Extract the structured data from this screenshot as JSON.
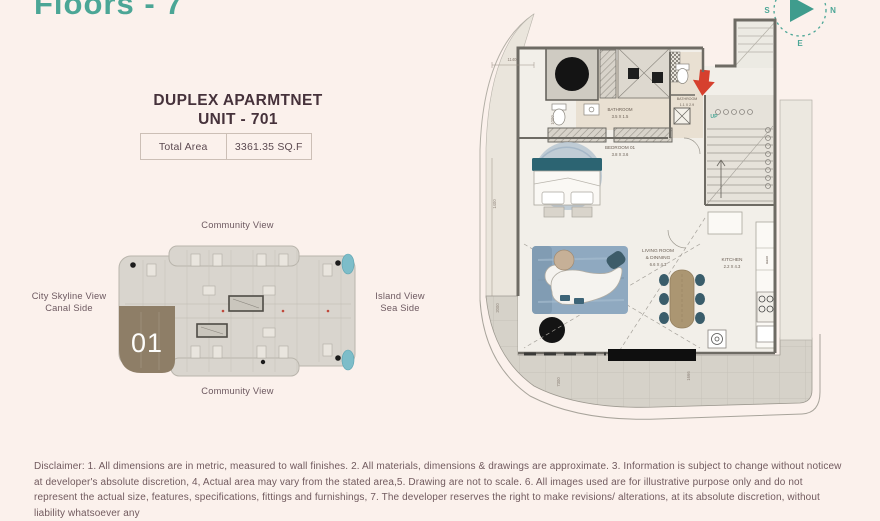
{
  "header": {
    "title": "Floors - 7",
    "compass": {
      "n": "N",
      "e": "E",
      "s": "S",
      "w": "W"
    }
  },
  "unit_info": {
    "heading_line1": "DUPLEX APARMTNET",
    "heading_line2": "UNIT - 701",
    "total_area_label": "Total Area",
    "total_area_value": "3361.35 SQ.F"
  },
  "key_plan": {
    "unit_number": "01",
    "view_top": "Community View",
    "view_bottom": "Community View",
    "view_left_line1": "City Skyline View",
    "view_left_line2": "Canal Side",
    "view_right_line1": "Island View",
    "view_right_line2": "Sea Side"
  },
  "floor_plan": {
    "bathroom1_name": "BATHROOM",
    "bathroom1_dims": "3.5 X 1.5",
    "bathroom2_name": "BATHROOM",
    "bathroom2_dims": "1.1 X 2.9",
    "bedroom_name": "BEDROOM 01",
    "bedroom_dims": "3.8 X 3.6",
    "living_name_line1": "LIVING ROOM",
    "living_name_line2": "& DINNING",
    "living_dims": "6.6 X 4.3",
    "kitchen_name": "KITCHEN",
    "kitchen_dims": "2.2 X 4.3",
    "oven_label": "oven",
    "up_label": "UP",
    "dim_top": "1140",
    "dim_vanity": "1000",
    "dim_left_mid": "1400",
    "dim_left_low": "2000",
    "dim_terrace": "7300",
    "dim_terrace_right": "1666"
  },
  "colors": {
    "accent_teal": "#4ba696",
    "heading_text": "#46323b",
    "label_text": "#6d5960",
    "unit_fill": "#8e7e67",
    "entry_arrow": "#d6402e",
    "wall": "#6e6b64",
    "rug": "#8fa9c0",
    "bed_headboard": "#2c6472",
    "pool": "#7dbdc9"
  },
  "disclaimer": "Disclaimer: 1. All dimensions are in metric, measured to wall finishes. 2. All materials, dimensions & drawings are approximate. 3. Information is subject to change without noticew at developer's absolute discretion, 4, Actual area may vary from the stated area,5. Drawing are not to scale. 6. All images used are for illustrative purpose only and do not represent the actual size, features, specifications, fittings and furnishings, 7. The developer reserves the right to make revisions/ alterations, at its absolute discretion, without liability whatsoever any"
}
